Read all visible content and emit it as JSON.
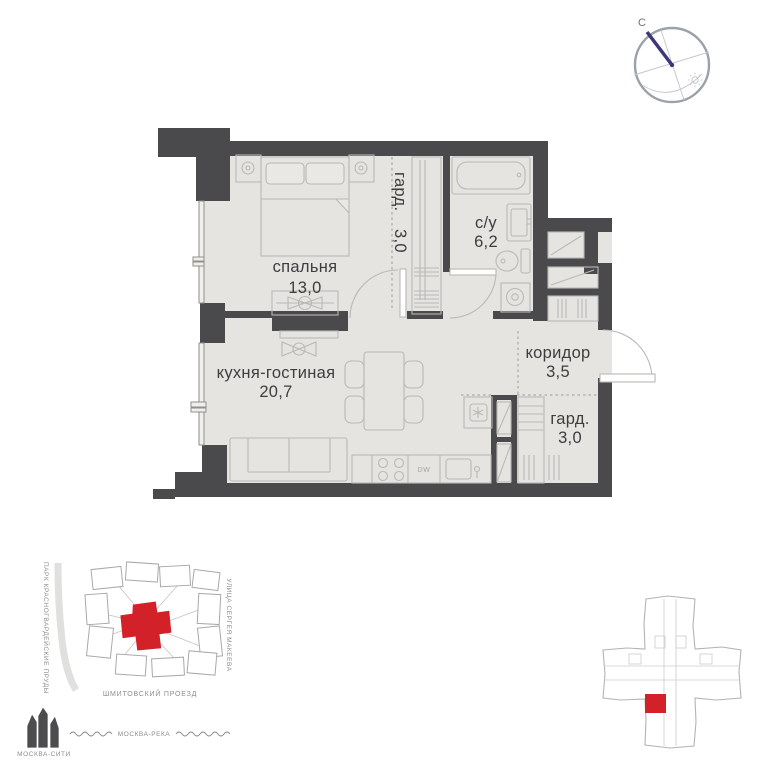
{
  "plan": {
    "rooms": {
      "bedroom": {
        "name": "спальня",
        "area": "13,0"
      },
      "wardrobe_top": {
        "name": "гард.",
        "area": "3,0"
      },
      "bathroom": {
        "name": "с/у",
        "area": "6,2"
      },
      "kitchen_living": {
        "name": "кухня-гостиная",
        "area": "20,7"
      },
      "corridor": {
        "name": "коридор",
        "area": "3,5"
      },
      "wardrobe_bottom": {
        "name": "гард.",
        "area": "3,0"
      }
    },
    "appliances": {
      "dishwasher": "DW"
    }
  },
  "compass": {
    "north": "С"
  },
  "location_map": {
    "park_label": "ПАРК КРАСНОГВАРДЕЙСКИЕ ПРУДЫ",
    "street_right": "УЛИЦА СЕРГЕЯ МАКЕЕВА",
    "street_bottom": "ШМИТОВСКИЙ ПРОЕЗД",
    "river": "МОСКВА-РЕКА",
    "landmark": "МОСКВА-СИТИ"
  },
  "colors": {
    "wall": "#4a4a4d",
    "floor": "#e5e4e1",
    "accent_red": "#d3212a",
    "compass_needle": "#3c3878"
  }
}
